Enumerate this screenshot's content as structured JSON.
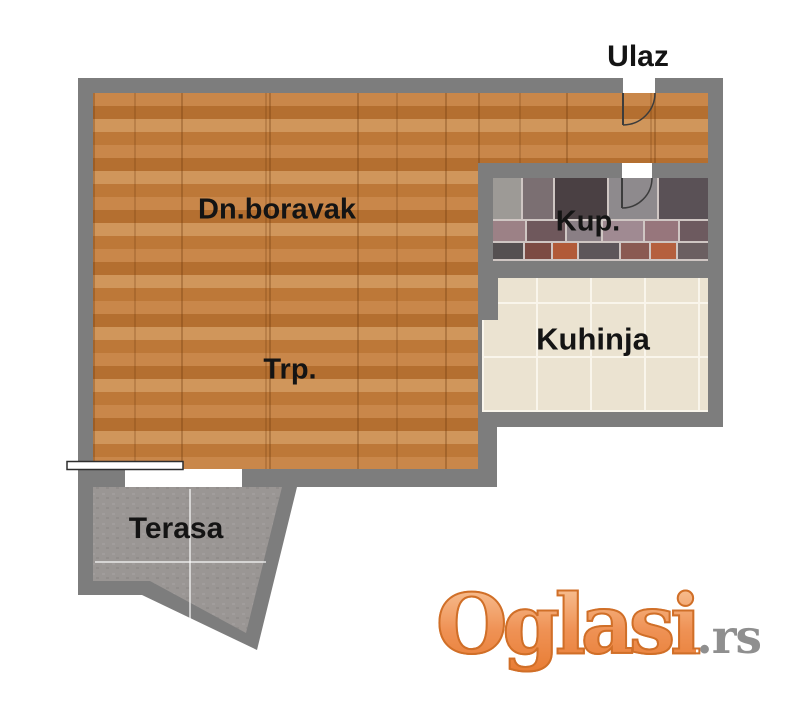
{
  "rooms": {
    "entrance_label": "Ulaz",
    "living_label": "Dn.boravak",
    "bathroom_label": "Kup.",
    "kitchen_label": "Kuhinja",
    "dining_label": "Trp.",
    "terrace_label": "Terasa"
  },
  "watermark": {
    "brand": "Oglasi",
    "suffix": ".rs"
  },
  "colors": {
    "wall": "#7d7d7d",
    "wood_a": "#c9874a",
    "wood_b": "#b46f30",
    "wood_c": "#d0965b",
    "wood_d": "#bd7838",
    "kitchen_tile": "#ebe3d1",
    "kitchen_grout": "#f9f5eb",
    "concrete": "#9a9694",
    "bath_grout": "#cfc6c3",
    "label": "#141414",
    "door_line": "#3c3c3c",
    "wm_top": "#f9c9a0",
    "wm_mid": "#ef9255",
    "wm_bottom": "#e87c33",
    "wm_stroke": "#d06f28",
    "wm_gray": "#8f8f8f"
  },
  "bathroom_tiles": {
    "rows": [
      {
        "h": 41,
        "tiles": [
          {
            "w": 28,
            "c": "#9d9a96"
          },
          {
            "w": 30,
            "c": "#7b6f72"
          },
          {
            "w": 52,
            "c": "#4a4043"
          },
          {
            "w": 48,
            "c": "#8e8a8d"
          },
          {
            "w": 49,
            "c": "#5a5156"
          }
        ]
      },
      {
        "h": 20,
        "tiles": [
          {
            "w": 32,
            "c": "#9c8186"
          },
          {
            "w": 38,
            "c": "#6f585c"
          },
          {
            "w": 34,
            "c": "#8a7f85"
          },
          {
            "w": 40,
            "c": "#a08a92"
          },
          {
            "w": 33,
            "c": "#97767c"
          },
          {
            "w": 28,
            "c": "#6d5a5f"
          }
        ]
      },
      {
        "h": 16,
        "tiles": [
          {
            "w": 30,
            "c": "#555051"
          },
          {
            "w": 26,
            "c": "#7c4b43"
          },
          {
            "w": 24,
            "c": "#b15a38"
          },
          {
            "w": 40,
            "c": "#5d565a"
          },
          {
            "w": 28,
            "c": "#8a5a52"
          },
          {
            "w": 25,
            "c": "#b5603e"
          },
          {
            "w": 30,
            "c": "#6b5f61"
          }
        ]
      }
    ]
  }
}
